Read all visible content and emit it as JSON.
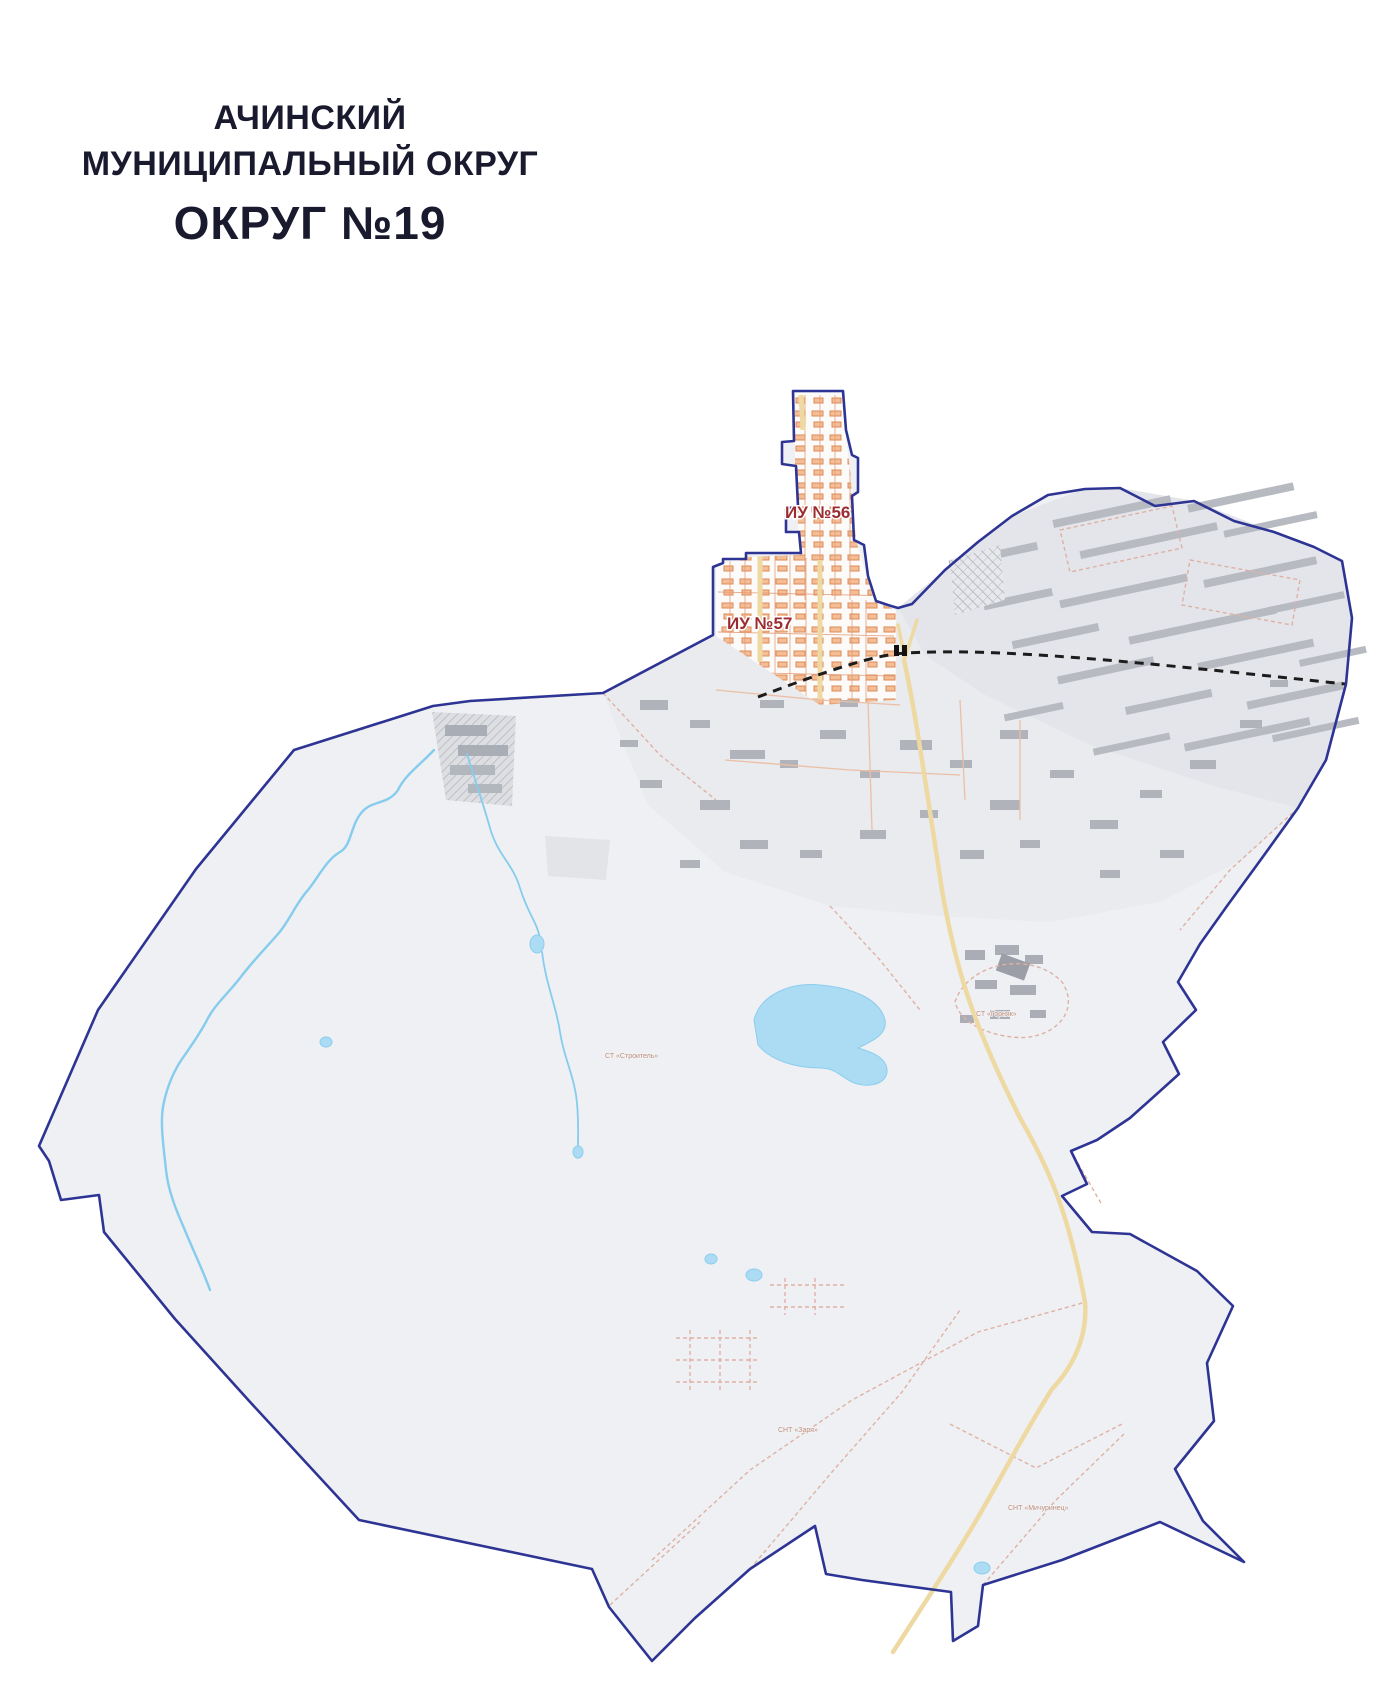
{
  "title": {
    "line1": "АЧИНСКИЙ",
    "line2": "МУНИЦИПАЛЬНЫЙ ОКРУГ",
    "line3": "ОКРУГ №19"
  },
  "map": {
    "labels": [
      {
        "text": "ИУ №56"
      },
      {
        "text": "ИУ №57"
      }
    ],
    "micro_labels": [
      {
        "text": "СТ «Строитель»"
      },
      {
        "text": "СТ «Горняк»"
      },
      {
        "text": "СНТ «Заря»"
      },
      {
        "text": "СНТ «Мичуринец»"
      }
    ]
  },
  "colors": {
    "title_text": "#191a2e",
    "boundary": "#2d3494",
    "label_red": "#9c2c32",
    "land": "#eef0f3",
    "urban": "#e9ebee",
    "industrial": "#e3e5ea",
    "water": "#86ccee",
    "lake_fill": "#abdcf4",
    "road_major": "#eed9a2",
    "road_minor_dashed": "#dfb1a4",
    "houses": "#dd8a58",
    "buildings": "#b7bac1",
    "railway": "#1c1c1c"
  }
}
